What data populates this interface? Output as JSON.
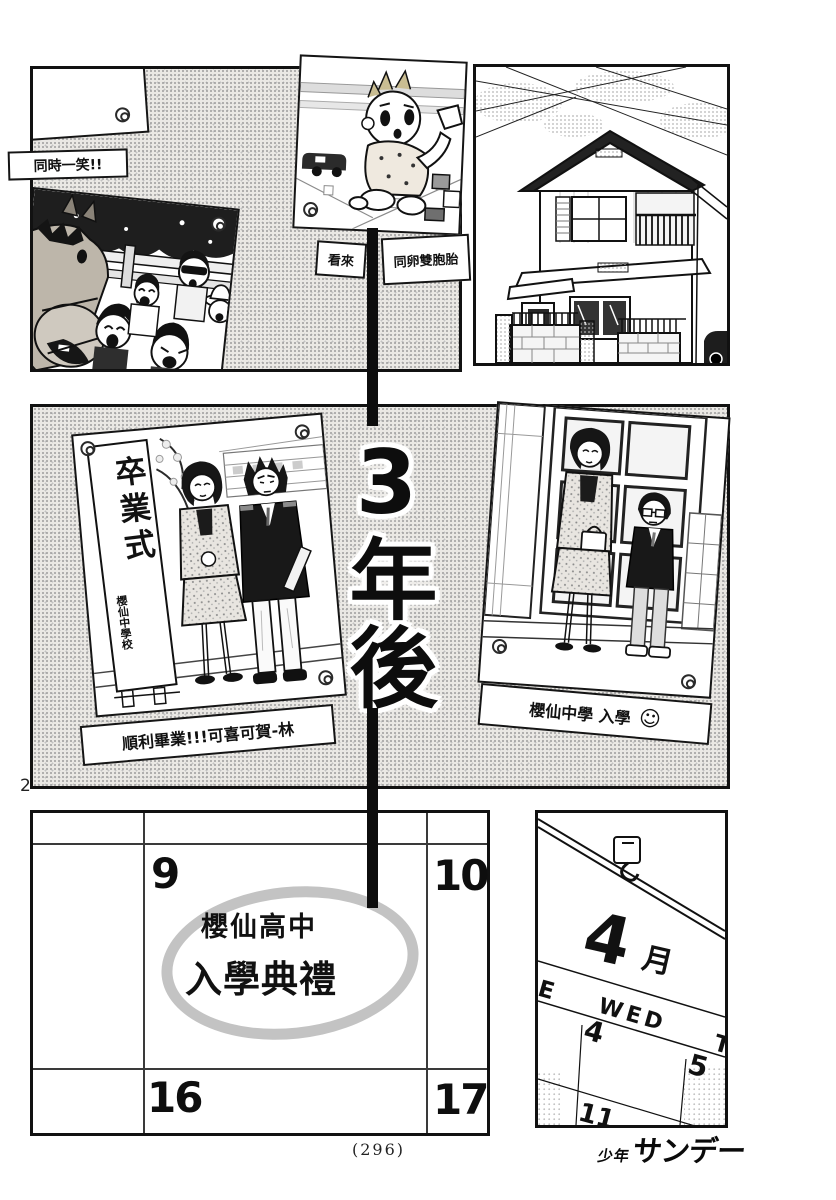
{
  "page": {
    "number": "2",
    "folio": "(296)"
  },
  "logo": {
    "small": "少年",
    "large": "サンデー"
  },
  "top_row": {
    "smile_caption": "同時一笑!!",
    "baby_caption_left": "看來",
    "baby_caption_right": "同卵雙胞胎"
  },
  "timeline": {
    "label": "3年後"
  },
  "middle": {
    "sign_title": "卒業式",
    "sign_school": "櫻仙中學校",
    "grad_caption": "順利畢業!!!可喜可賀-林",
    "entrance_caption": "櫻仙中學 入學",
    "smiley_glyph": "☺"
  },
  "calendar_left": {
    "days": [
      "9",
      "10",
      "16",
      "17"
    ],
    "note_line1": "櫻仙高中",
    "note_line2": "入學典禮"
  },
  "calendar_right": {
    "month": "4",
    "month_unit": "月",
    "weekday_left": "E",
    "weekday_mid": "WED",
    "weekday_right": "T",
    "day_a": "4",
    "day_b": "5",
    "day_c": "11"
  },
  "colors": {
    "ink": "#111111",
    "tone_gray": "#c3c3c3",
    "paper": "#ffffff"
  }
}
